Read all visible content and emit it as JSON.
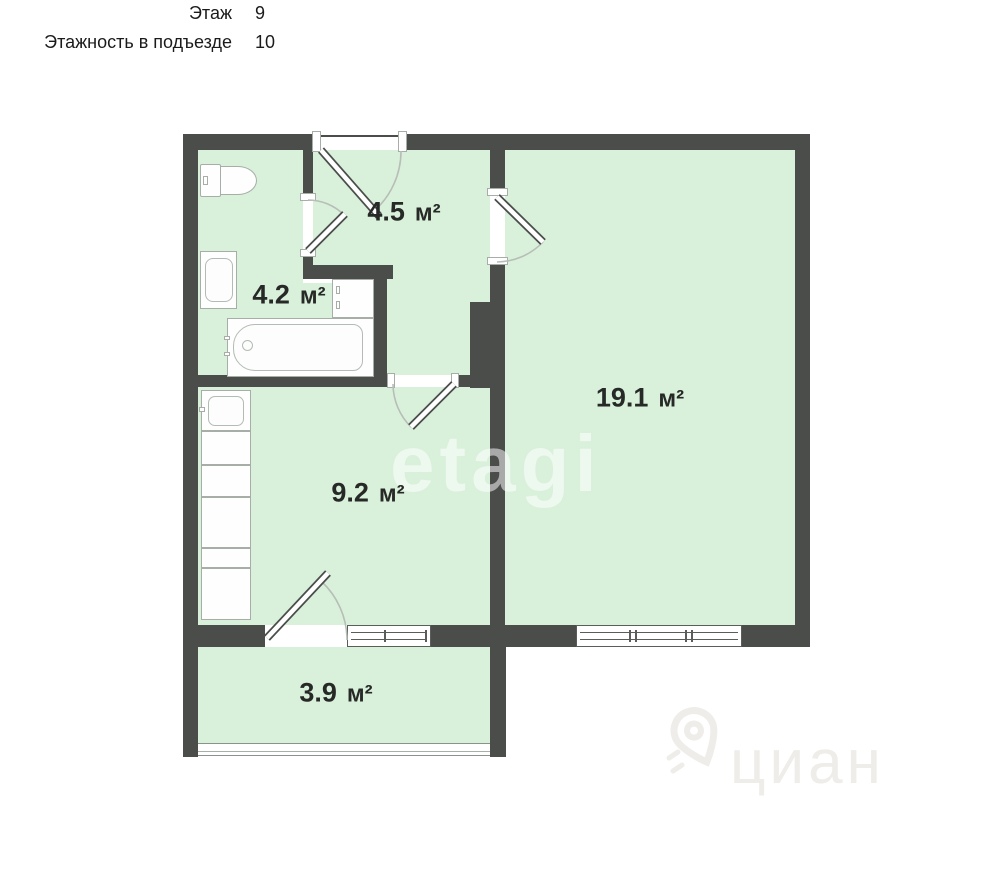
{
  "header": {
    "rows": [
      {
        "label": "Этаж",
        "value": "9"
      },
      {
        "label": "Этажность в подъезде",
        "value": "10"
      }
    ]
  },
  "plan": {
    "rooms": [
      {
        "id": "hallway",
        "area": "4.5",
        "unit": "м²"
      },
      {
        "id": "bathroom",
        "area": "4.2",
        "unit": "м²"
      },
      {
        "id": "living-room",
        "area": "19.1",
        "unit": "м²"
      },
      {
        "id": "kitchen",
        "area": "9.2",
        "unit": "м²"
      },
      {
        "id": "balcony",
        "area": "3.9",
        "unit": "м²"
      }
    ],
    "fixtures": [
      "toilet",
      "sink",
      "washing-machine",
      "bathtub",
      "kitchen-sink",
      "kitchen-counter"
    ],
    "colors": {
      "wall": "#4a4d4a",
      "floor": "#d9f0db",
      "background": "#ffffff",
      "fixture_outline": "#a6aea7"
    },
    "watermarks": {
      "center": "etagi",
      "bottom_right": "циан"
    }
  }
}
